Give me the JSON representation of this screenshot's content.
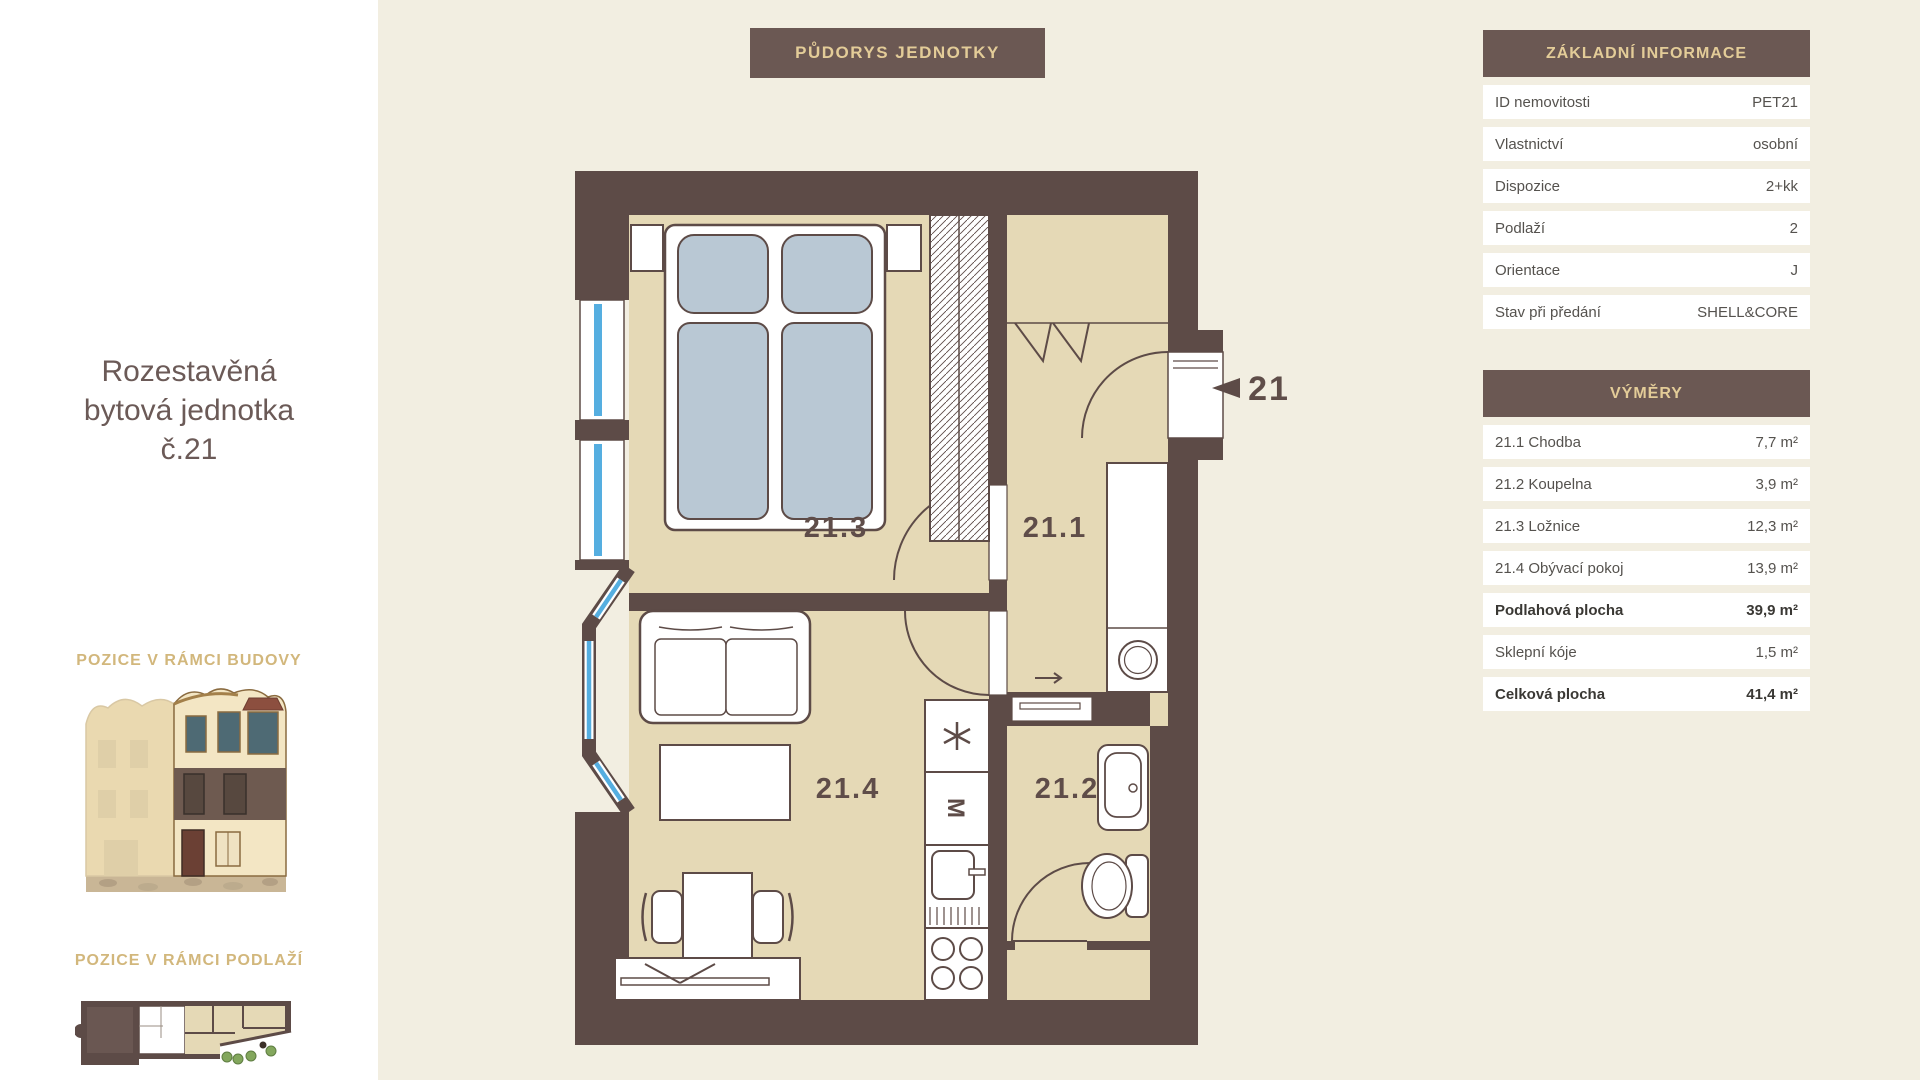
{
  "sidebar": {
    "title_lines": [
      "Rozestavěná",
      "bytová jednotka",
      "č.21"
    ],
    "section_building": "POZICE V RÁMCI BUDOVY",
    "section_floor": "POZICE V RÁMCI PODLAŽÍ"
  },
  "plan": {
    "title": "PŮDORYS JEDNOTKY",
    "unit_marker": "21",
    "labels": {
      "hall": "21.1",
      "bathroom": "21.2",
      "bedroom": "21.3",
      "living": "21.4"
    },
    "kitchen_oven_symbol": "M"
  },
  "basic_info": {
    "title": "ZÁKLADNÍ INFORMACE",
    "rows": [
      {
        "label": "ID nemovitosti",
        "value": "PET21"
      },
      {
        "label": "Vlastnictví",
        "value": "osobní"
      },
      {
        "label": "Dispozice",
        "value": "2+kk"
      },
      {
        "label": "Podlaží",
        "value": "2"
      },
      {
        "label": "Orientace",
        "value": "J"
      },
      {
        "label": "Stav při předání",
        "value": "SHELL&CORE"
      }
    ]
  },
  "areas": {
    "title": "VÝMĚRY",
    "rows": [
      {
        "label": "21.1 Chodba",
        "value": "7,7 m²"
      },
      {
        "label": "21.2 Koupelna",
        "value": "3,9 m²"
      },
      {
        "label": "21.3 Ložnice",
        "value": "12,3 m²"
      },
      {
        "label": "21.4 Obývací pokoj",
        "value": "13,9 m²"
      },
      {
        "label": "Podlahová plocha",
        "value": "39,9 m²",
        "bold": true
      },
      {
        "label": "Sklepní kóje",
        "value": "1,5 m²"
      },
      {
        "label": "Celková plocha",
        "value": "41,4 m²",
        "bold": true
      }
    ]
  },
  "colors": {
    "page_bg": "#f2eee1",
    "sidebar_bg": "#ffffff",
    "wall": "#5d4b47",
    "floor": "#e5d9b6",
    "header_bg": "#6b5853",
    "header_text": "#e3cc98",
    "accent_gold": "#d2b77c",
    "window_blue": "#55aee0",
    "bedding_blue": "#b9c8d4"
  }
}
